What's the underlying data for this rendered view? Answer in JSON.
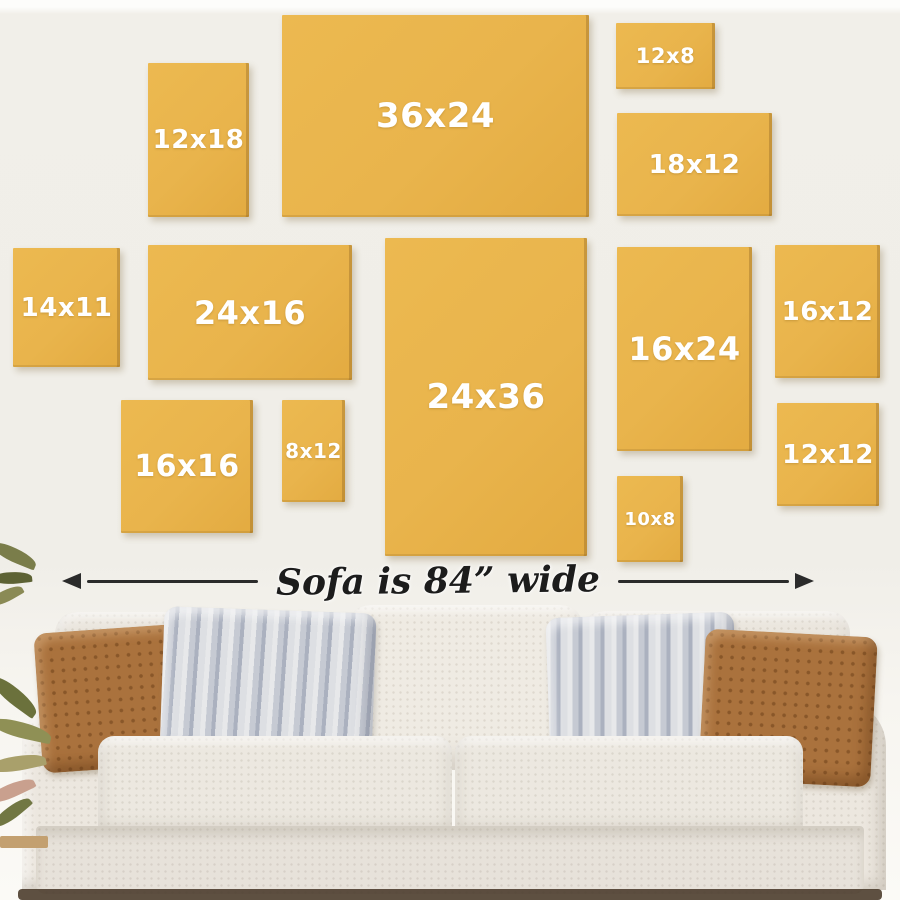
{
  "wall": {
    "color": "#f0eee8"
  },
  "frames": {
    "fill_color": "#e9b44c",
    "label_color": "#ffffff",
    "items": [
      {
        "label": "12x18"
      },
      {
        "label": "36x24"
      },
      {
        "label": "12x8"
      },
      {
        "label": "18x12"
      },
      {
        "label": "14x11"
      },
      {
        "label": "24x16"
      },
      {
        "label": "24x36"
      },
      {
        "label": "16x24"
      },
      {
        "label": "16x12"
      },
      {
        "label": "16x16"
      },
      {
        "label": "8x12"
      },
      {
        "label": "10x8"
      },
      {
        "label": "12x12"
      }
    ]
  },
  "sofa_note": {
    "text": "Sofa is 84” wide",
    "arrow_color": "#2b2b2b"
  },
  "sofa_colors": {
    "body": "#eae5dd",
    "rust_pillow": "#aa723d",
    "stripe_pillow": "#c6cad3"
  }
}
